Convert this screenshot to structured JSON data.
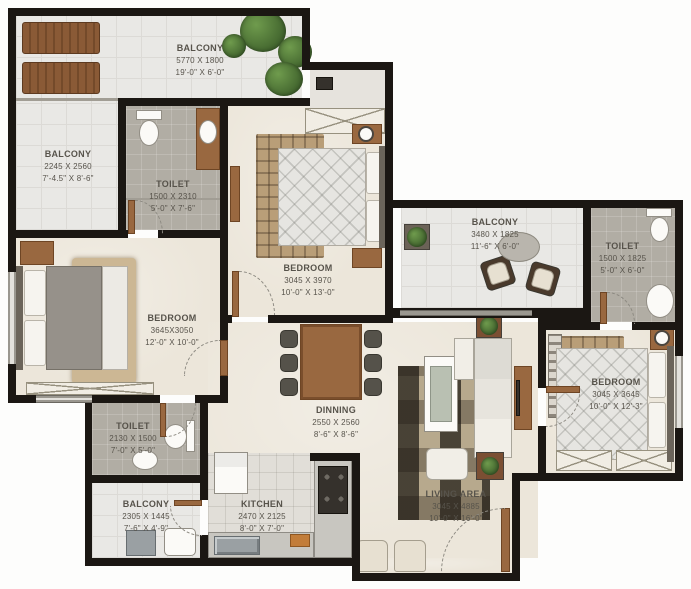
{
  "figure_type": "apartment-floor-plan",
  "palette": {
    "wall": "#1b1713",
    "balcony_tile": "#e9e8e5",
    "interior_floor": "#ece6da",
    "toilet_floor": "#b1ada4",
    "kitchen_floor": "#e1ded8",
    "wood": "#996840",
    "greenery": "#4e7a38",
    "label_text": "#57534b"
  },
  "rooms": [
    {
      "id": "balcony-top",
      "name": "BALCONY",
      "mm": "5770 X 1800",
      "ft": "19'-0\" X 6'-0\""
    },
    {
      "id": "balcony-left",
      "name": "BALCONY",
      "mm": "2245 X 2560",
      "ft": "7'-4.5\" X 8'-6\""
    },
    {
      "id": "toilet-top",
      "name": "TOILET",
      "mm": "1500 X 2310",
      "ft": "5'-0\" X 7'-6\""
    },
    {
      "id": "bedroom-top",
      "name": "BEDROOM",
      "mm": "3045 X 3970",
      "ft": "10'-0\" X 13'-0\""
    },
    {
      "id": "balcony-right",
      "name": "BALCONY",
      "mm": "3480 X 1825",
      "ft": "11'-6\" X 6'-0\""
    },
    {
      "id": "toilet-right",
      "name": "TOILET",
      "mm": "1500 X 1825",
      "ft": "5'-0\" X 6'-0\""
    },
    {
      "id": "bedroom-left",
      "name": "BEDROOM",
      "mm": "3645X3050",
      "ft": "12'-0\" X 10'-0\""
    },
    {
      "id": "bedroom-right",
      "name": "BEDROOM",
      "mm": "3045 X 3645",
      "ft": "10'-0\" X 12'-3\""
    },
    {
      "id": "dining",
      "name": "DINNING",
      "mm": "2550 X 2560",
      "ft": "8'-6\" X 8'-6\""
    },
    {
      "id": "toilet-bottom",
      "name": "TOILET",
      "mm": "2130 X 1500",
      "ft": "7'-0\" X 5'-0\""
    },
    {
      "id": "balcony-bottom",
      "name": "BALCONY",
      "mm": "2305 X 1445",
      "ft": "7'-6\" X 4'-9\""
    },
    {
      "id": "kitchen",
      "name": "KITCHEN",
      "mm": "2470 X 2125",
      "ft": "8'-0\" X 7'-0\""
    },
    {
      "id": "living",
      "name": "LIVING AREA",
      "mm": "3045 X 4885",
      "ft": "10'-0\" X 16'-0\""
    }
  ],
  "furniture_icons": [
    "sun-lounger",
    "plant",
    "toilet-wc",
    "washbasin",
    "vanity-counter",
    "double-bed",
    "pillow",
    "wardrobe",
    "rug",
    "nightstand",
    "dining-table",
    "dining-chair",
    "sofa",
    "armchair",
    "coffee-table",
    "tv-unit",
    "planter",
    "balcony-chair",
    "leaf-table",
    "fridge",
    "gas-stove",
    "kitchen-sink",
    "counter",
    "washing-area-sink",
    "door-swing",
    "window",
    "clock"
  ]
}
